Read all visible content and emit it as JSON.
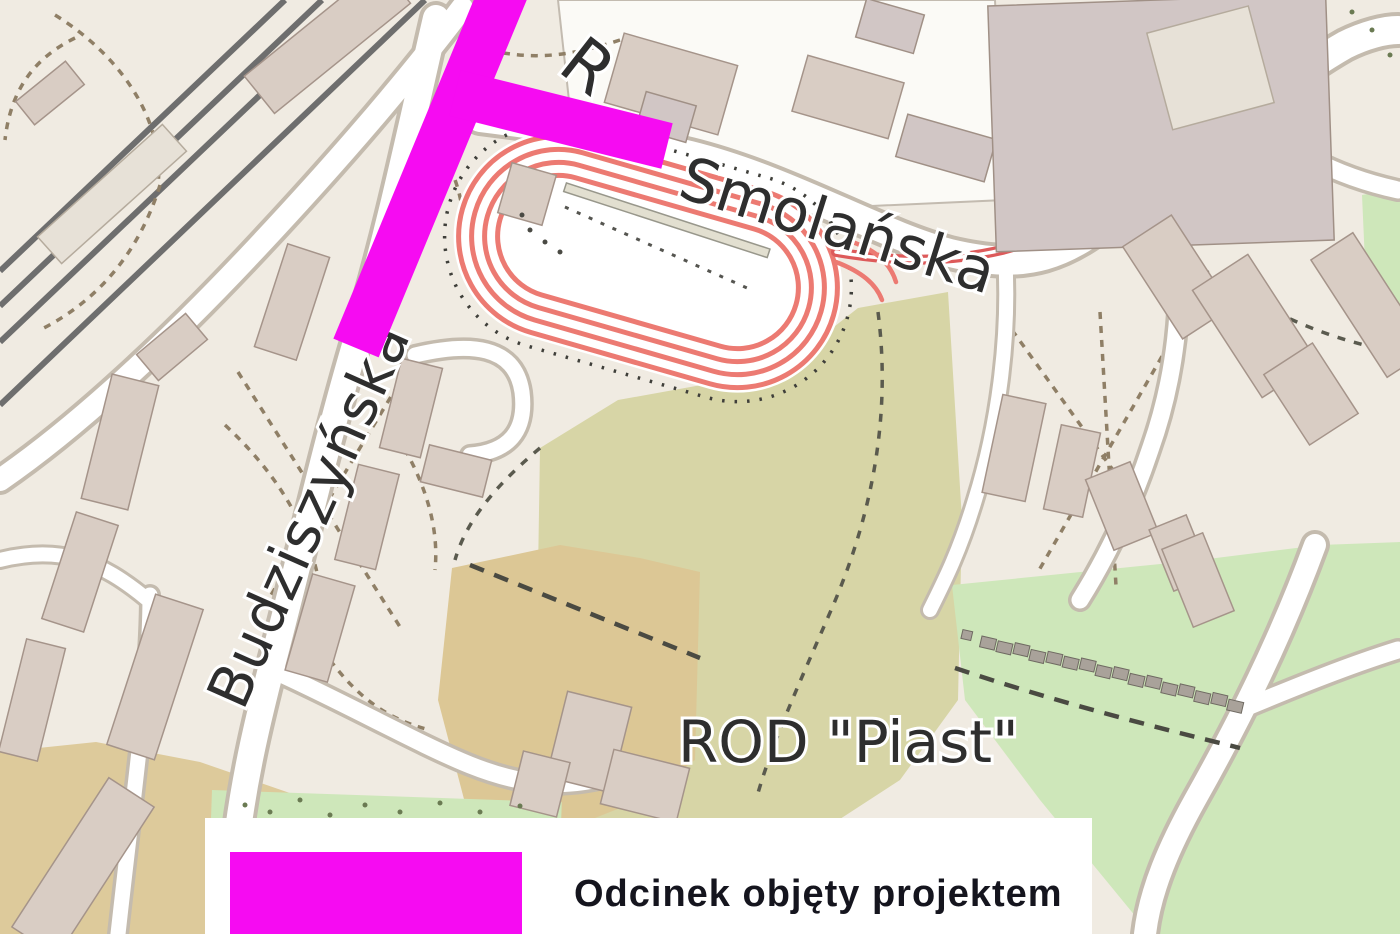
{
  "map": {
    "labels": {
      "street_partial": "R",
      "smolanska": "Smolańska",
      "budziszynska": "Budziszyńska",
      "rod_piast": "ROD \"Piast\""
    }
  },
  "legend": {
    "label": "Odcinek objęty projektem"
  },
  "colors": {
    "background": "#f0ebe2",
    "industrial_ground": "#fbfaf6",
    "green_park": "#cee7ba",
    "green_allotment": "#d7d5a6",
    "tan_area": "#dcc795",
    "tan_area_sw": "#ddca9b",
    "highlight_magenta": "#f60bf2",
    "tram_loop_red": "#ec7a72",
    "tram_line_red": "#dd5a5a",
    "legend_box": "#ffffff",
    "legend_text": "#15151e"
  }
}
